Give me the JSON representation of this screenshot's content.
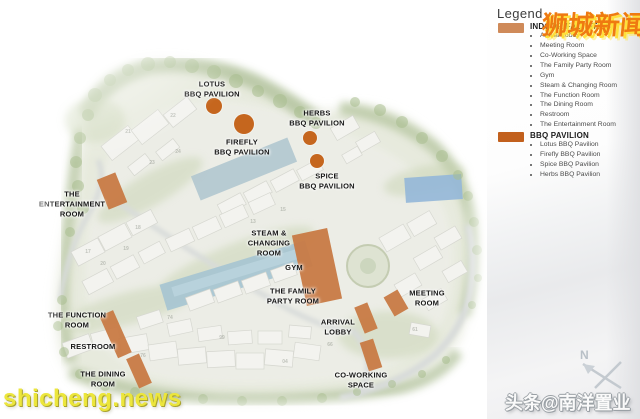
{
  "accent": {
    "block": "#C97B45",
    "dot": "#C5661E",
    "legend_indoor_swatch": "#CF8A59",
    "legend_bbq_swatch": "#C2601D"
  },
  "legend": {
    "title": "Legend",
    "sections": [
      {
        "heading": "INDOOR FACILITIES",
        "swatch_color": "#CF8A59",
        "items": [
          "Arrival Lobby",
          "Meeting Room",
          "Co-Working Space",
          "The Family Party Room",
          "Gym",
          "Steam & Changing Room",
          "The Function Room",
          "The Dining Room",
          "Restroom",
          "The Entertainment Room"
        ]
      },
      {
        "heading": "BBQ PAVILION",
        "swatch_color": "#C2601D",
        "items": [
          "Lotus BBQ Pavilion",
          "Firefly BBQ Pavilion",
          "Spice BBQ Pavilion",
          "Herbs BBQ Pavilion"
        ]
      }
    ]
  },
  "map": {
    "labels": [
      {
        "id": "lotus-bbq-pavilion",
        "lines": [
          "LOTUS",
          "BBQ PAVILION"
        ],
        "x": 212,
        "y": 89,
        "dot": {
          "x": 214,
          "y": 106,
          "r": 8
        }
      },
      {
        "id": "firefly-bbq-pavilion",
        "lines": [
          "FIREFLY",
          "BBQ PAVILION"
        ],
        "x": 242,
        "y": 147,
        "dot": {
          "x": 244,
          "y": 124,
          "r": 10
        }
      },
      {
        "id": "herbs-bbq-pavilion",
        "lines": [
          "HERBS",
          "BBQ PAVILION"
        ],
        "x": 317,
        "y": 118,
        "dot": {
          "x": 310,
          "y": 138,
          "r": 7
        }
      },
      {
        "id": "spice-bbq-pavilion",
        "lines": [
          "SPICE",
          "BBQ PAVILION"
        ],
        "x": 327,
        "y": 181,
        "dot": {
          "x": 317,
          "y": 161,
          "r": 7
        }
      },
      {
        "id": "the-entertainment-room",
        "lines": [
          "THE",
          "ENTERTAINMENT",
          "ROOM"
        ],
        "x": 72,
        "y": 204
      },
      {
        "id": "steam-changing-room",
        "lines": [
          "STEAM &",
          "CHANGING",
          "ROOM"
        ],
        "x": 269,
        "y": 243
      },
      {
        "id": "gym",
        "lines": [
          "GYM"
        ],
        "x": 294,
        "y": 268
      },
      {
        "id": "the-family-party-room",
        "lines": [
          "THE FAMILY",
          "PARTY ROOM"
        ],
        "x": 293,
        "y": 296
      },
      {
        "id": "arrival-lobby",
        "lines": [
          "ARRIVAL",
          "LOBBY"
        ],
        "x": 338,
        "y": 327
      },
      {
        "id": "meeting-room",
        "lines": [
          "MEETING",
          "ROOM"
        ],
        "x": 427,
        "y": 298
      },
      {
        "id": "co-working-space",
        "lines": [
          "CO-WORKING",
          "SPACE"
        ],
        "x": 361,
        "y": 380
      },
      {
        "id": "the-function-room",
        "lines": [
          "THE FUNCTION",
          "ROOM"
        ],
        "x": 77,
        "y": 320
      },
      {
        "id": "restroom",
        "lines": [
          "RESTROOM"
        ],
        "x": 93,
        "y": 347
      },
      {
        "id": "the-dining-room",
        "lines": [
          "THE DINING",
          "ROOM"
        ],
        "x": 103,
        "y": 379
      }
    ],
    "unit_numbers": [
      {
        "n": "21",
        "x": 128,
        "y": 132
      },
      {
        "n": "22",
        "x": 173,
        "y": 116
      },
      {
        "n": "23",
        "x": 152,
        "y": 163
      },
      {
        "n": "24",
        "x": 178,
        "y": 152
      },
      {
        "n": "18",
        "x": 138,
        "y": 228
      },
      {
        "n": "19",
        "x": 126,
        "y": 249
      },
      {
        "n": "17",
        "x": 88,
        "y": 252
      },
      {
        "n": "20",
        "x": 103,
        "y": 264
      },
      {
        "n": "13",
        "x": 253,
        "y": 222
      },
      {
        "n": "15",
        "x": 283,
        "y": 210
      },
      {
        "n": "74",
        "x": 170,
        "y": 318
      },
      {
        "n": "99",
        "x": 222,
        "y": 338
      },
      {
        "n": "76",
        "x": 143,
        "y": 356
      },
      {
        "n": "04",
        "x": 285,
        "y": 362
      },
      {
        "n": "66",
        "x": 330,
        "y": 345
      },
      {
        "n": "61",
        "x": 415,
        "y": 330
      }
    ]
  },
  "compass": {
    "label": "N"
  },
  "watermarks": {
    "top_right": "狮城新闻",
    "bottom_left": "shicheng.news",
    "bottom_right": "头条@南洋置业"
  }
}
